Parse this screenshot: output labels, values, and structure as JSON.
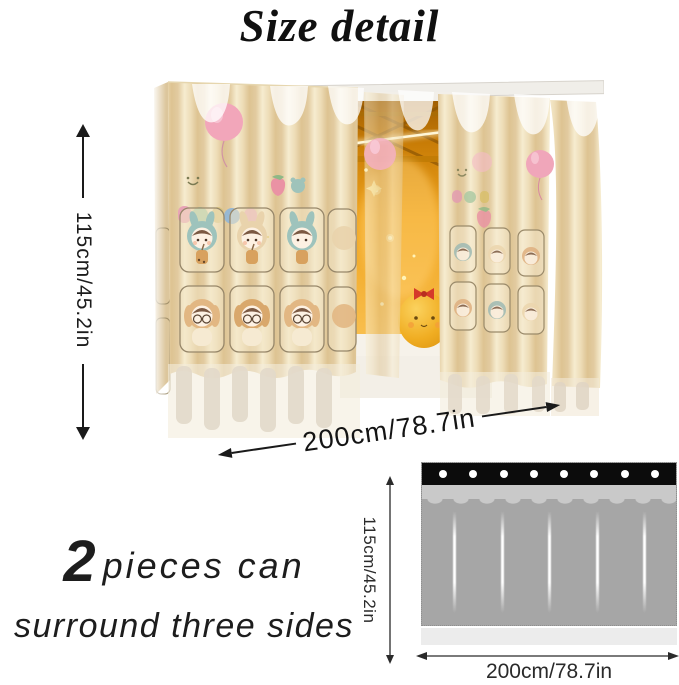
{
  "title": "Size detail",
  "photo": {
    "description": "bed curtain with cartoon print, opening showing lit interior",
    "height_label": "115cm/45.2in",
    "width_label": "200cm/78.7in"
  },
  "note": {
    "count": "2",
    "line1_rest": "pieces can",
    "line2": "surround three sides"
  },
  "diagram": {
    "height_label": "115cm/45.2in",
    "width_label": "200cm/78.7in",
    "grommet_count": 8,
    "fold_count": 5,
    "colors": {
      "header_strip": "#0c0c0c",
      "top_band": "#c9c9c9",
      "body": "#a6a6a6",
      "hem": "#ececec"
    }
  },
  "colors": {
    "curtain_fabric": "#ecd9b2",
    "balloon_pink": "#f2a6ba",
    "interior_glow": "#efa31d",
    "plush_yellow": "#eead24",
    "dimension_arrow": "#1a1a1a"
  }
}
